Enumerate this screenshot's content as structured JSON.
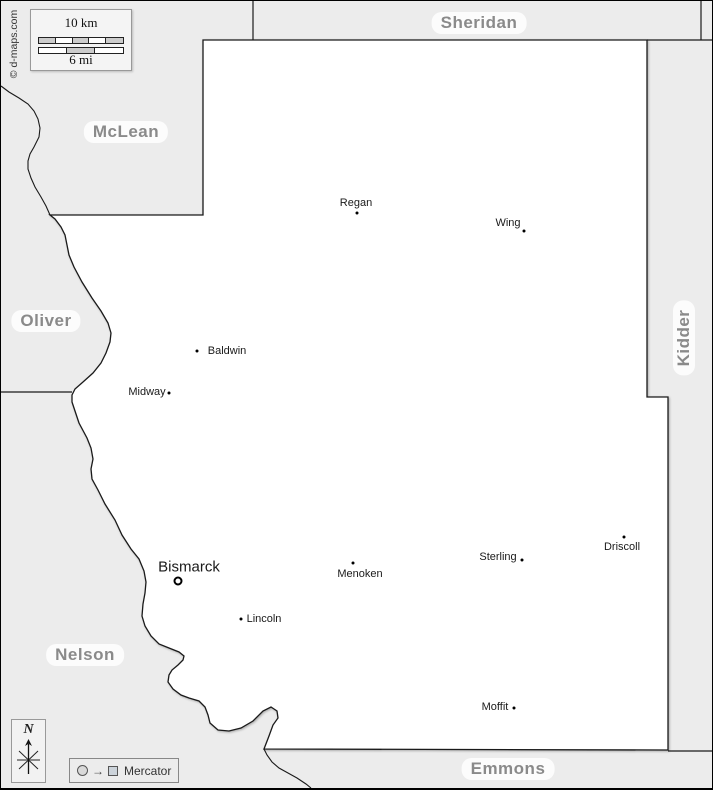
{
  "attribution": "© d-maps.com",
  "scale": {
    "km_label": "10 km",
    "mi_label": "6 mi"
  },
  "north": {
    "label": "N"
  },
  "projection": {
    "label": "Mercator"
  },
  "counties": {
    "north": "Sheridan",
    "northwest": "McLean",
    "west": "Oliver",
    "east": "Kidder",
    "southwest": "Nelson",
    "south": "Emmons"
  },
  "county_seat": {
    "name": "Bismarck"
  },
  "towns": [
    {
      "name": "Regan"
    },
    {
      "name": "Wing"
    },
    {
      "name": "Baldwin"
    },
    {
      "name": "Midway"
    },
    {
      "name": "Driscoll"
    },
    {
      "name": "Sterling"
    },
    {
      "name": "Menoken"
    },
    {
      "name": "Lincoln"
    },
    {
      "name": "Moffit"
    }
  ],
  "colors": {
    "outside_fill": "#ececec",
    "county_fill": "#ffffff",
    "boundary": "#1a1a1a",
    "county_label": "#8a8a8a",
    "scale_segment": "#cccccc"
  }
}
